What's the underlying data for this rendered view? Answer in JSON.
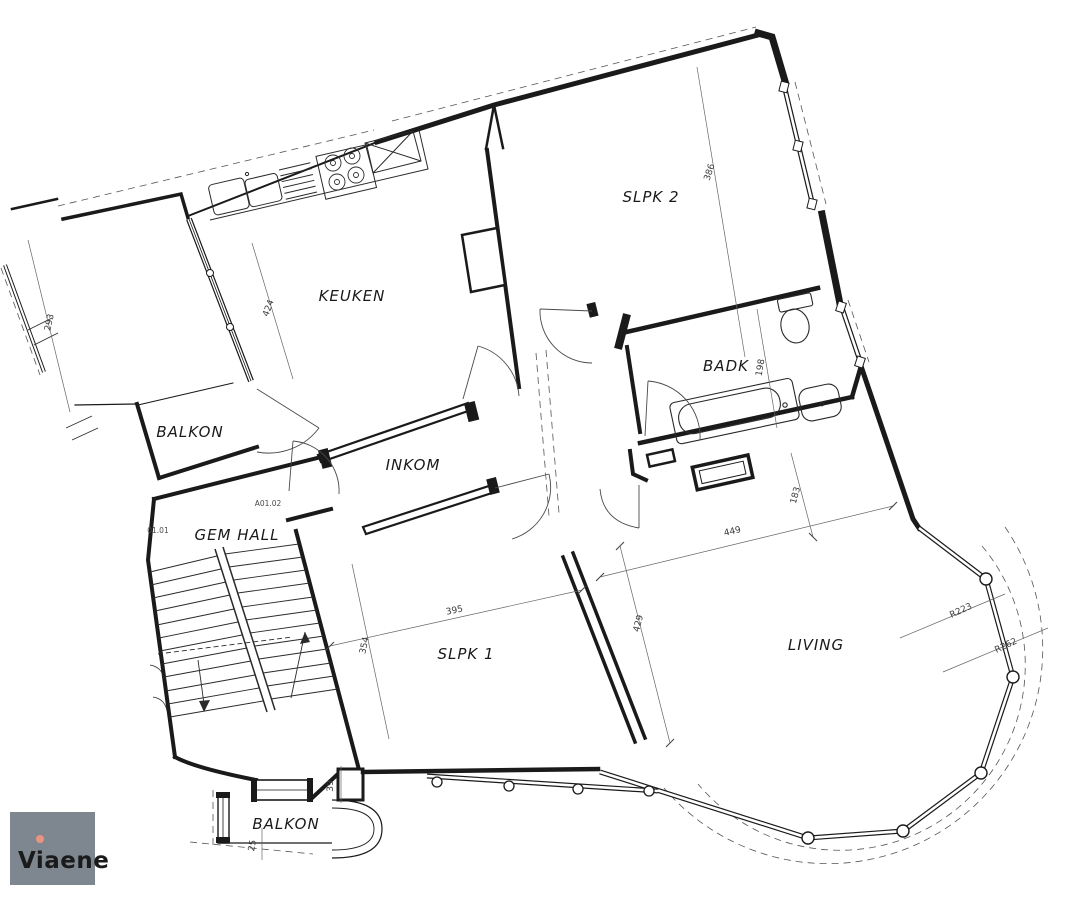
{
  "document": {
    "kind": "apartment floor plan"
  },
  "rooms": {
    "keuken": "KEUKEN",
    "slpk2": "SLPK 2",
    "badk": "BADK",
    "balkon_left": "BALKON",
    "inkom": "INKOM",
    "gem_hall": "GEM HALL",
    "slpk1": "SLPK 1",
    "living": "LIVING",
    "balkon_bottom": "BALKON"
  },
  "codes": {
    "stair_hall": "01.01",
    "apartment_door": "A01.02"
  },
  "dimensions": {
    "left_room": "293",
    "keuken_partition": "424",
    "slpk2_length": "386",
    "badk_depth": "198",
    "slpk1_width": "395",
    "slpk1_depth": "354",
    "living_west": "429",
    "living_width": "449",
    "living_north": "183",
    "bay_radius_inner": "R223",
    "bay_radius_outer": "R262",
    "wall_offset": "39",
    "balkon_offset": "25"
  },
  "branding": {
    "logo_text": "Viaene",
    "logo_bg": "#7e8790",
    "logo_text_color": "#ffffff",
    "logo_pin_color": "#e8947e"
  },
  "colors": {
    "line": "#1a1a1a",
    "background": "#ffffff"
  }
}
